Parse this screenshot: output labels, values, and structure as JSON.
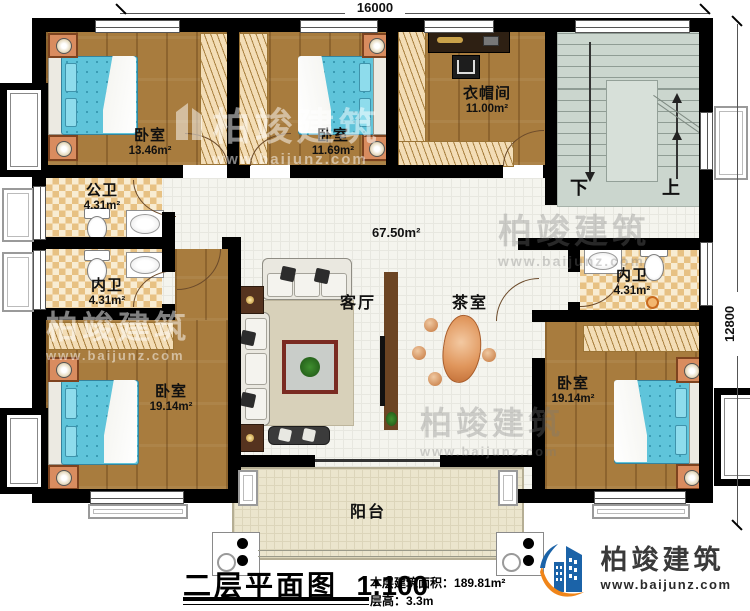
{
  "plan": {
    "dim_top": "16000",
    "dim_right": "12800",
    "hall_area": "67.50m²",
    "stair_down": "下",
    "stair_up": "上",
    "rooms": {
      "bedroom_top_left": {
        "name": "卧室",
        "area": "13.46m²"
      },
      "bedroom_top_mid": {
        "name": "卧室",
        "area": "11.69m²"
      },
      "cloakroom": {
        "name": "衣帽间",
        "area": "11.00m²"
      },
      "public_bath": {
        "name": "公卫",
        "area": "4.31m²"
      },
      "inner_bath_left": {
        "name": "内卫",
        "area": "4.31m²"
      },
      "inner_bath_right": {
        "name": "内卫",
        "area": "4.31m²"
      },
      "bedroom_bottom_left": {
        "name": "卧室",
        "area": "19.14m²"
      },
      "bedroom_bottom_right": {
        "name": "卧室",
        "area": "19.14m²"
      },
      "living_room": {
        "name": "客厅"
      },
      "tea_room": {
        "name": "茶室"
      },
      "balcony": {
        "name": "阳台"
      }
    }
  },
  "title_block": {
    "title": "二层平面图",
    "scale": "1:100",
    "floor_area_label": "本层建筑面积：",
    "floor_area_value": "189.81m²",
    "floor_height_label": "层高：",
    "floor_height_value": "3.3m"
  },
  "brand": {
    "name": "柏竣建筑",
    "website": "www.baijunz.com"
  },
  "watermark": {
    "name": "柏竣建筑",
    "website": "www.baijunz.com"
  },
  "colors": {
    "wall": "#000000",
    "wood_floor": "#a87c3e",
    "tile_dark": "#e7c183",
    "bed": "#5fc4da",
    "stairs": "#cbd6ce",
    "balcony_floor": "#ebe5cd",
    "brand_blue": "#1b63a8",
    "brand_orange": "#f08519"
  }
}
